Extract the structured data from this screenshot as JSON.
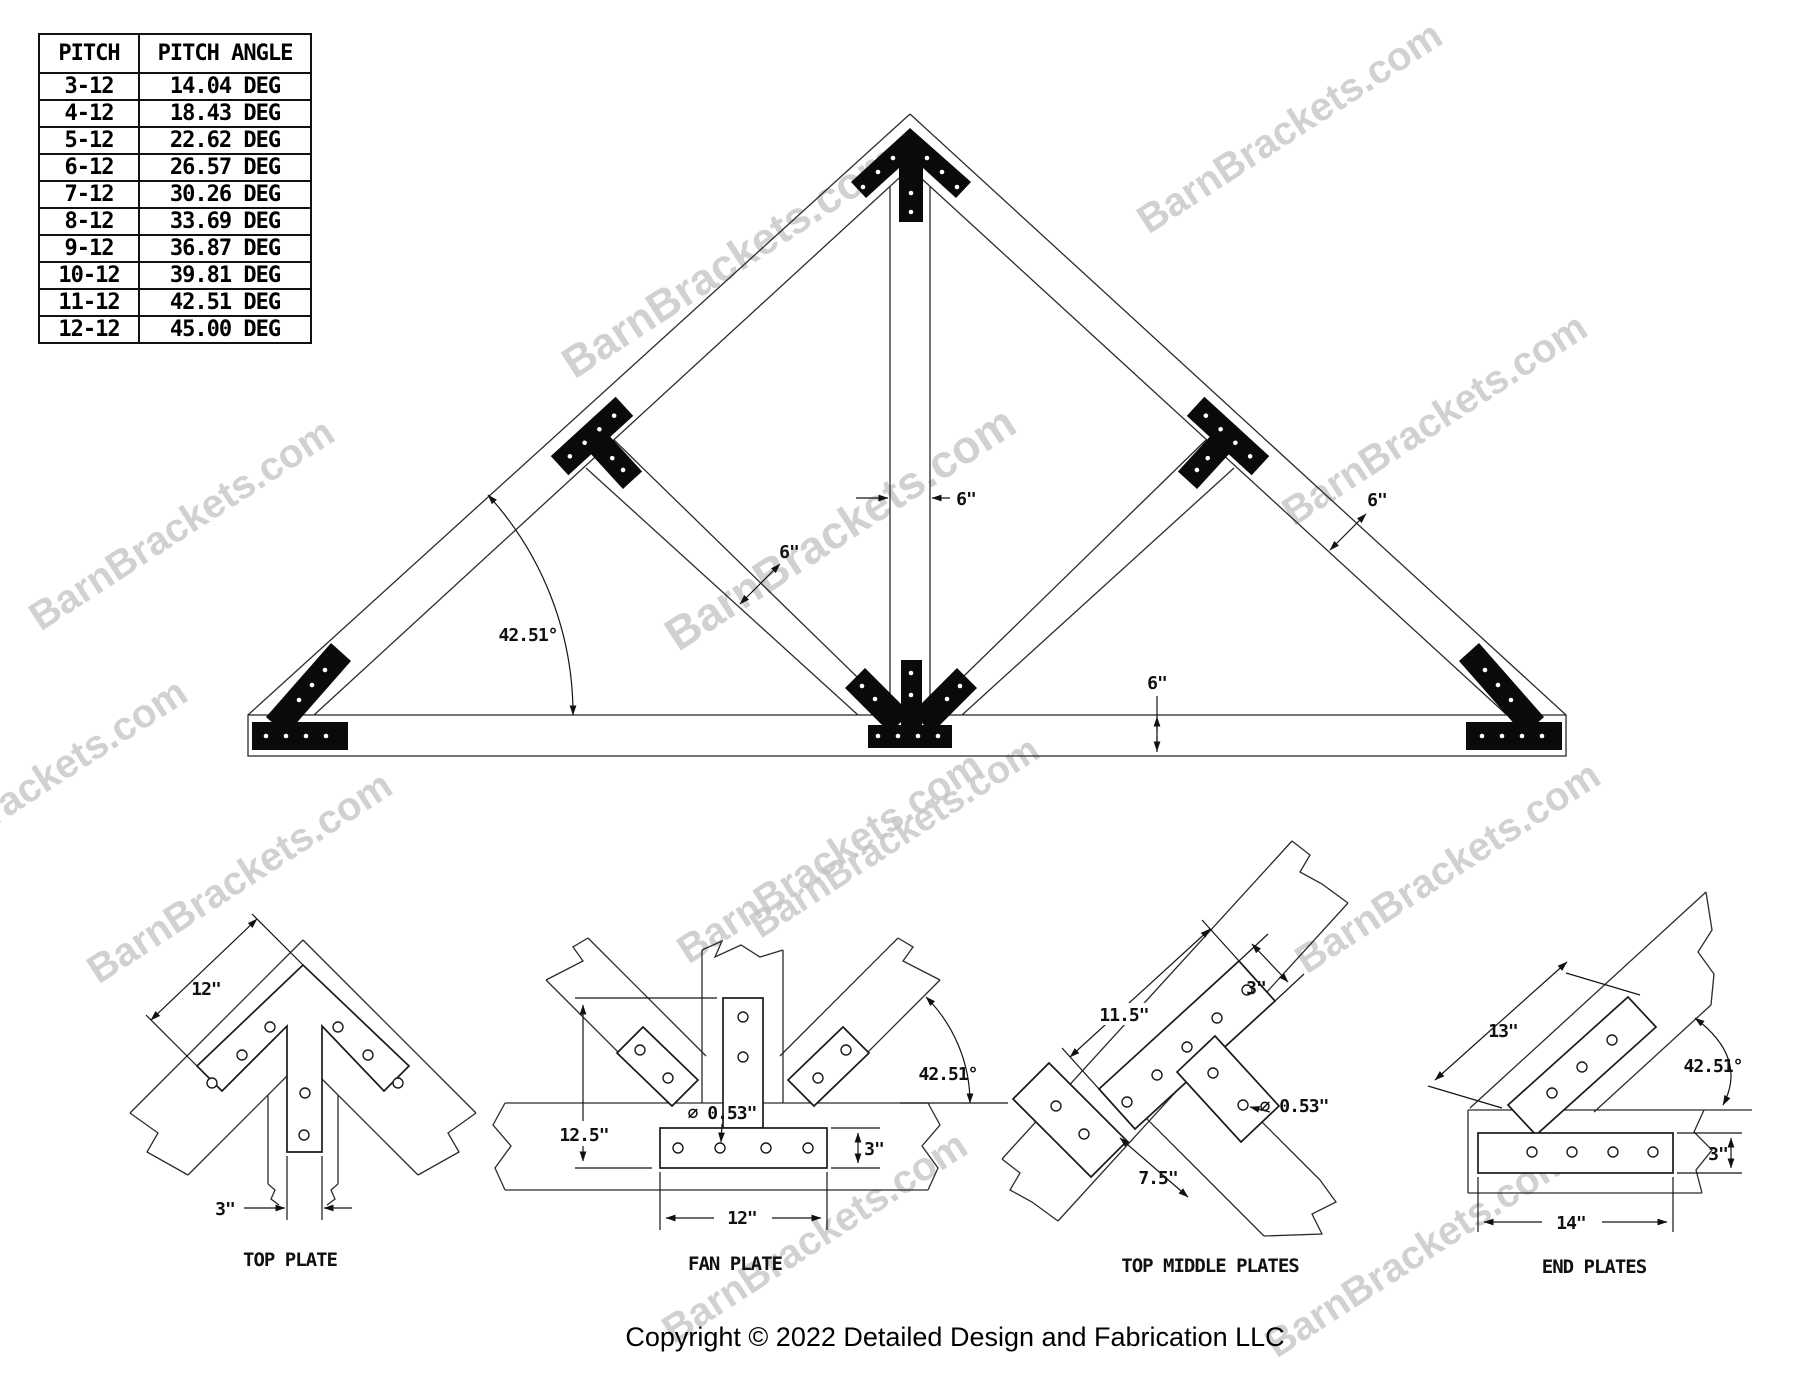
{
  "watermark_text": "BarnBrackets.com",
  "pitch_table": {
    "headers": [
      "PITCH",
      "PITCH ANGLE"
    ],
    "rows": [
      [
        "3-12",
        "14.04 DEG"
      ],
      [
        "4-12",
        "18.43 DEG"
      ],
      [
        "5-12",
        "22.62 DEG"
      ],
      [
        "6-12",
        "26.57 DEG"
      ],
      [
        "7-12",
        "30.26 DEG"
      ],
      [
        "8-12",
        "33.69 DEG"
      ],
      [
        "9-12",
        "36.87 DEG"
      ],
      [
        "10-12",
        "39.81 DEG"
      ],
      [
        "11-12",
        "42.51 DEG"
      ],
      [
        "12-12",
        "45.00 DEG"
      ]
    ]
  },
  "truss_dims": {
    "king_post": "6\"",
    "web": "6\"",
    "rafter": "6\"",
    "chord": "6\"",
    "angle": "42.51°"
  },
  "details": {
    "top_plate": {
      "title": "TOP PLATE",
      "dim_length": "12\"",
      "dim_width": "3\""
    },
    "fan_plate": {
      "title": "FAN PLATE",
      "dim_height": "12.5\"",
      "dim_hole": "⌀ 0.53\"",
      "dim_width": "3\"",
      "dim_base": "12\"",
      "dim_angle": "42.51°"
    },
    "top_middle": {
      "title": "TOP MIDDLE PLATES",
      "dim_length": "11.5\"",
      "dim_width": "3\"",
      "dim_hole": "⌀ 0.53\"",
      "dim_stem": "7.5\""
    },
    "end_plates": {
      "title": "END PLATES",
      "dim_diag": "13\"",
      "dim_angle": "42.51°",
      "dim_width": "3\"",
      "dim_base": "14\""
    }
  },
  "footer": {
    "copyright": "Copyright © 2022 Detailed Design and Fabrication LLC"
  }
}
